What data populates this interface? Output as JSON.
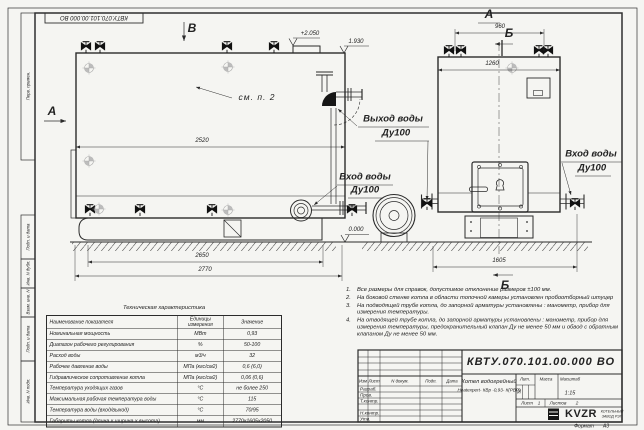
{
  "stamp_top": "КВТУ.070.101.00.000 ВО",
  "margin_labels": [
    "Перв. примен.",
    "Подп. и дата",
    "Инв. N дубл.",
    "Взам. инв. N",
    "Подп. и дата",
    "Инв. N подл."
  ],
  "view_markers": {
    "b": "В",
    "a_top": "А",
    "a_side": "А",
    "b_top": "Б",
    "b_bottom": "Б"
  },
  "callouts": {
    "see_item": "см. п. 2",
    "outlet_1": "Выход воды",
    "outlet_2": "Ду100",
    "inlet_side_1": "Вход воды",
    "inlet_side_2": "Ду100",
    "inlet_front_1": "Вход воды",
    "inlet_front_2": "Ду100"
  },
  "dimensions": {
    "body_length": "2520",
    "frame_length": "2650",
    "total_length": "2770",
    "top_width": "960",
    "body_width": "1260",
    "total_width": "1605"
  },
  "elevations": {
    "top": "+2.050",
    "mid": "1.930",
    "zero": "0.000"
  },
  "tech_table": {
    "title": "Техническая характеристика",
    "headers": [
      "Наименование показателя",
      "Единицы измерения",
      "Значение"
    ],
    "rows": [
      [
        "Номинальная мощность",
        "МВт",
        "0,93"
      ],
      [
        "Диапазон рабочего регулирования",
        "%",
        "50-100"
      ],
      [
        "Расход воды",
        "м3/ч",
        "32"
      ],
      [
        "Рабочее давление воды",
        "МПа (кгс/см2)",
        "0,6 (6,0)"
      ],
      [
        "Гидравлическое сопротивление котла",
        "МПа (кгс/см2)",
        "0,06 (0,6)"
      ],
      [
        "Температура уходящих газов",
        "°С",
        "не более 250"
      ],
      [
        "Максимальная рабочая температура воды",
        "°С",
        "115"
      ],
      [
        "Температура воды (вход/выход)",
        "°С",
        "70/95"
      ],
      [
        "Габариты котла (длина х ширина х высота)",
        "мм",
        "2770х1605х2050"
      ]
    ]
  },
  "notes": [
    {
      "num": "1.",
      "text": "Все размеры для справок, допустимое отклонение размеров ±100 мм."
    },
    {
      "num": "2.",
      "text": "На боковой стенке котла в области топочной камеры установлен пробоотборный штуцер"
    },
    {
      "num": "3.",
      "text": "На подводящей трубе котла, до запорной арматуры установлены : манометр, прибор для измерения температуры."
    },
    {
      "num": "4.",
      "text": "На отводящей трубе котла, до запорной арматуры установлены : манометр, прибор для измерения температуры, предохранительный клапан Ду не менее 50 мм и обвод с обратным клапаном Ду не менее 50 мм."
    }
  ],
  "title_block": {
    "doc_number": "КВТУ.070.101.00.000 ВО",
    "product_name_1": "Котел водогрейный",
    "product_name_2": "Heatexpert- КВр -0,93- К(РВР)",
    "header_cols": [
      "Изм",
      "Лист",
      "N докум.",
      "Подп.",
      "Дата"
    ],
    "sign_rows": [
      "Разраб.",
      "Пров.",
      "Т.контр.",
      "Н.контр.",
      "Утв."
    ],
    "lit_label": "Лит.",
    "lit_value": "И",
    "mass_label": "Масса",
    "scale_label": "Масштаб",
    "scale_value": "1:15",
    "sheet_label": "Лист",
    "sheet_value": "1",
    "sheets_label": "Листов",
    "sheets_value": "2",
    "logo_text": "KVZR",
    "logo_sub_1": "КОТЕЛЬНЫЙ",
    "logo_sub_2": "ЗАВОД РЭП",
    "format_label": "Формат",
    "format_value": "А3"
  }
}
